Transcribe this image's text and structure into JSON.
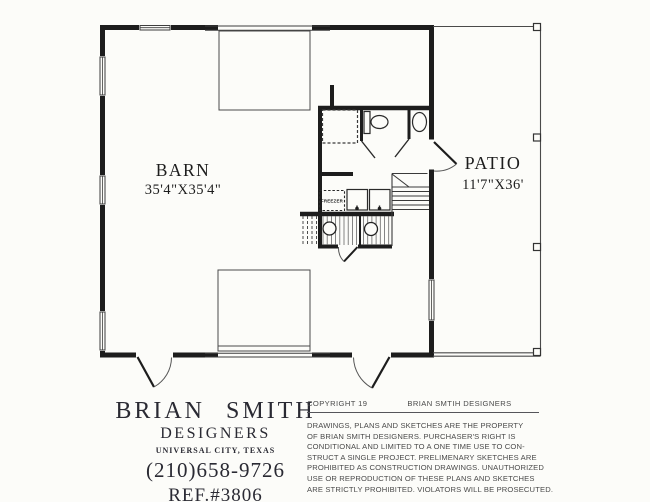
{
  "plan": {
    "barn": {
      "label": "BARN",
      "dimensions": "35'4\"X35'4\""
    },
    "patio": {
      "label": "PATIO",
      "dimensions": "11'7\"X36'"
    },
    "freezer_label": "FREEZER"
  },
  "footer": {
    "designer": {
      "name": "BRIAN SMITH",
      "role": "DESIGNERS",
      "location": "UNIVERSAL CITY, TEXAS",
      "phone": "(210)658-9726",
      "reference": "REF.#3806"
    },
    "copyright": {
      "label": "COPYRIGHT 19",
      "holder": "BRIAN SMTIH DESIGNERS",
      "notice_lines": [
        "DRAWINGS, PLANS AND SKETCHES ARE THE PROPERTY",
        "OF BRIAN SMITH DESIGNERS.  PURCHASER'S RIGHT IS",
        "CONDITIONAL AND LIMITED TO A ONE TIME USE TO CON-",
        "STRUCT A SINGLE PROJECT.  PRELIMENARY SKETCHES ARE",
        "PROHIBITED AS CONSTRUCTION DRAWINGS.  UNAUTHORIZED",
        "USE OR REPRODUCTION OF THESE PLANS AND SKETCHES",
        "ARE STRICTLY PROHIBITED.  VIOLATORS WILL BE PROSECUTED."
      ]
    }
  },
  "colors": {
    "ink": "#1d1d1d",
    "paper": "#fcfcf9",
    "line": "#444444",
    "text_gray": "#4a4a4a"
  }
}
